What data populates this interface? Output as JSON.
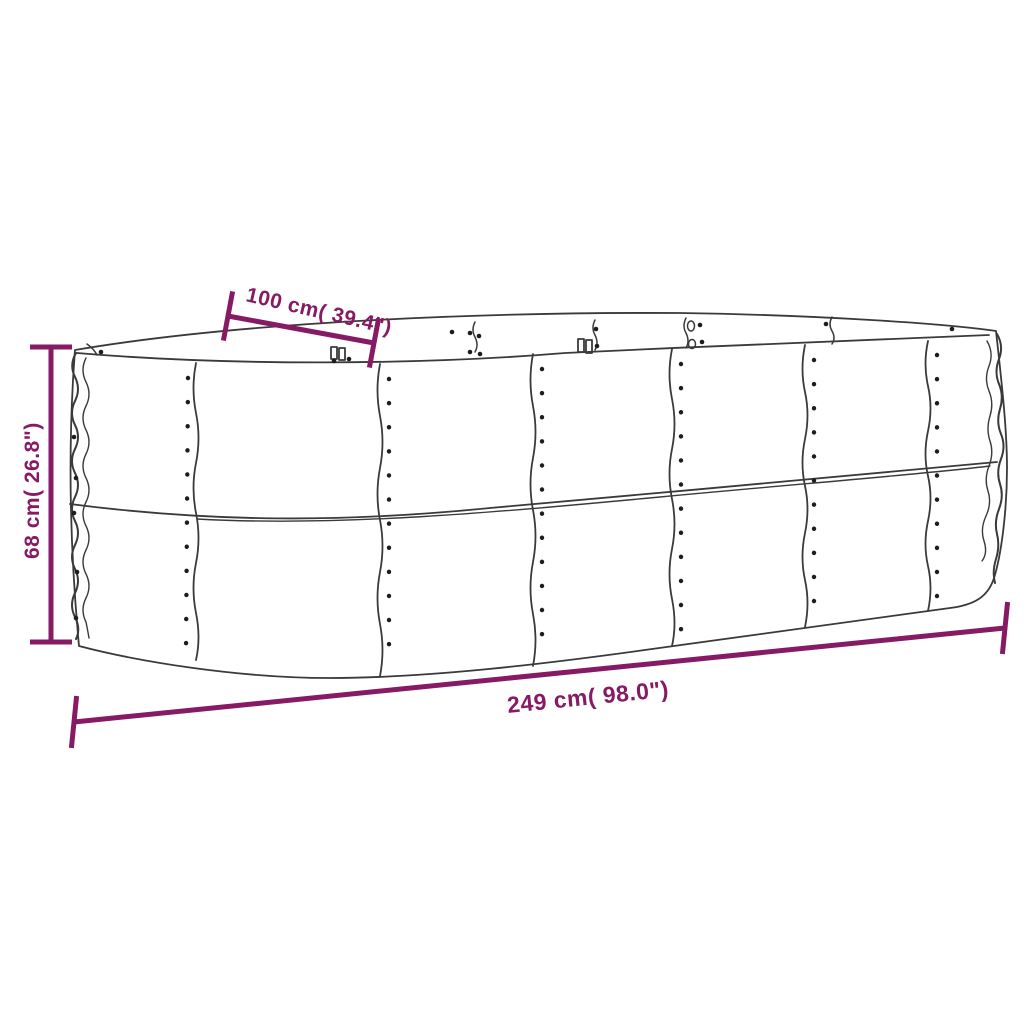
{
  "diagram": {
    "type": "product-dimension-diagram",
    "subject": "oval corrugated metal raised garden bed",
    "labels": {
      "width": "100 cm( 39.4\")",
      "height": "68 cm( 26.8\")",
      "length": "249 cm( 98.0\")"
    },
    "dimensions": {
      "length_cm": 249,
      "length_inches": 98.0,
      "width_cm": 100,
      "width_inches": 39.4,
      "height_cm": 68,
      "height_inches": 26.8
    }
  },
  "colors": {
    "dimension_annotation": "#871a64",
    "line_art": "#3a3a3a",
    "rivet_dots": "#1d1d1d",
    "background": "#ffffff"
  }
}
